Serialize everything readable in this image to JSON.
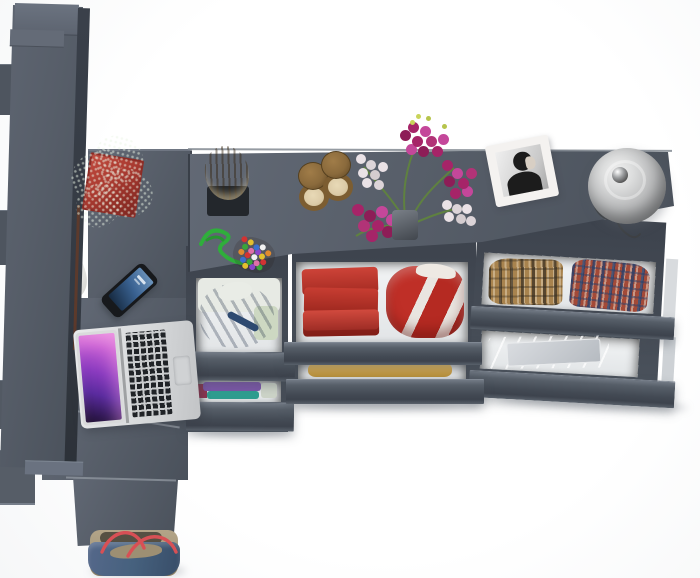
{
  "scene": {
    "description": "Top-down 3D product render of an anthracite gray corner desk and dresser set with open drawers of folded clothes, laptop, smartphone, plant, flowers, photo frame, lamp and tote bag",
    "view": "top view",
    "background": "#ffffff"
  },
  "furniture": {
    "surface": "#575e69",
    "surface_light": "#636a75",
    "surface_dark": "#4d545e",
    "side_dark": "#343a43",
    "drawer_front": "#4c535d",
    "drawer_front_edge": "#808893",
    "drawer_interior": "#eceef0"
  },
  "props": {
    "plant": {
      "pot": "#a93a30",
      "pot_dark": "#7e2620",
      "leaf": "#3c9440",
      "leaf_light": "#63bd62"
    },
    "earbuds": {
      "body": "#f0f0ee"
    },
    "smartphone": {
      "body": "#17191c",
      "screen_top": "#6d95bd",
      "screen_bottom": "#16293f"
    },
    "laptop": {
      "body": "#d8dadc",
      "keys": "#202327",
      "trackpad": "#d0d2d4",
      "screen_a": "#c75fd4",
      "screen_b": "#5a2b9e",
      "screen_c": "#1d1030"
    },
    "log": {
      "bark": "#9a7743",
      "bark_dark": "#6e5228",
      "cut": "#d9c9a2",
      "tray": "#23272c"
    },
    "bead_toy": {
      "cord": "#2fae3b"
    },
    "hourglasses": {
      "brass": "#8a6a3c",
      "brass_dark": "#5f4623",
      "sand": "#ddcca8"
    },
    "flowers": {
      "magenta": "#a62468",
      "magenta_light": "#c4479a",
      "white": "#eae2e6",
      "stem": "#5f8140",
      "vase": "#41464d"
    },
    "photo_frame": {
      "frame": "#f4f2f0",
      "photo_bg": "#c9c9c9",
      "silhouette": "#1c1c1c"
    },
    "lamp": {
      "shade_light": "#f0f0f0",
      "shade": "#b9babb",
      "shade_dark": "#7b7c7e",
      "chrome": "#555555"
    },
    "bag": {
      "denim": "#46617e",
      "khaki": "#a89a7e",
      "khaki_dark": "#877a5f",
      "handle": "#d85055",
      "lining": "#565043"
    }
  },
  "clothes": {
    "hoodie_blue": "#4b6fa3",
    "cloth_white": "#e7eae4",
    "stack_purple": "#7b57a8",
    "stack_teal": "#2f9e90",
    "stack_crimson": "#8e3550",
    "towels_red": "#c23a30",
    "garment_red": "#bf2f27",
    "garment_white_stripe": "#e9e5e0",
    "folded_yellow": "#d3a74d",
    "plaid_tan": "#a8834e",
    "plaid_red": "#a34a38",
    "plaid_blue": "#23406e",
    "stack_gray": "#c0c5ca"
  }
}
